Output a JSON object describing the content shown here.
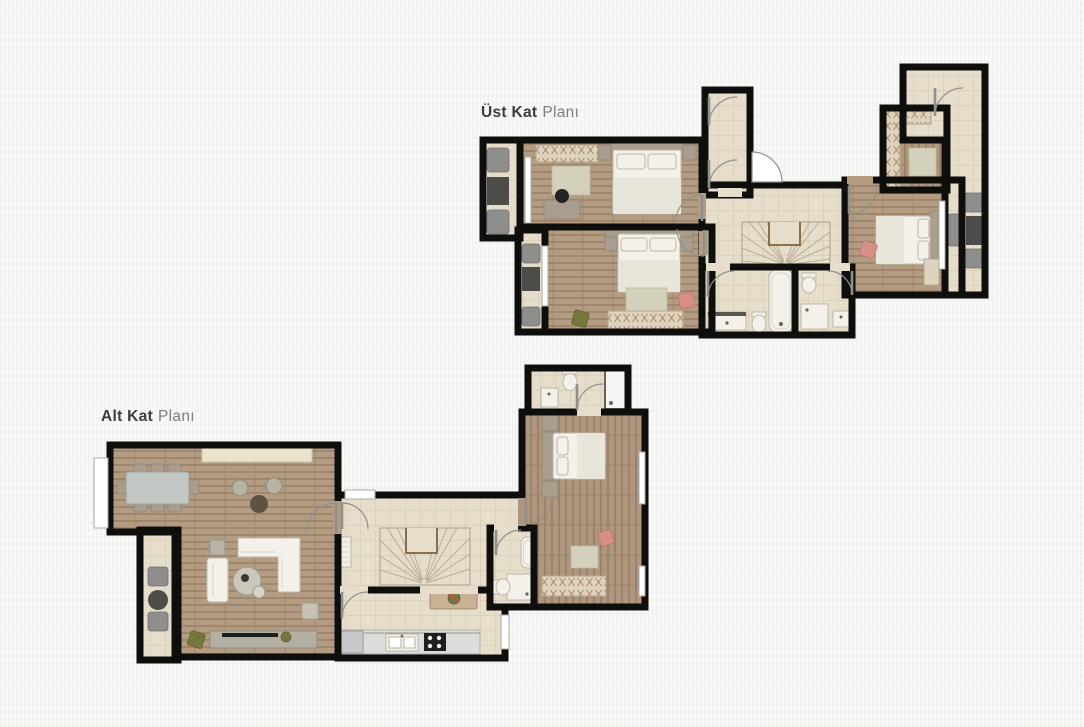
{
  "upper_plan": {
    "title_bold": "Üst Kat",
    "title_light": "Planı"
  },
  "lower_plan": {
    "title_bold": "Alt Kat",
    "title_light": "Planı"
  },
  "colors": {
    "paper": "#f8f8f5",
    "ink": "#3b3c3c",
    "inklight": "#7e7e79",
    "wall": "#0e0e0c",
    "wood": "#b49c83",
    "woodv": "#ae977e",
    "tile": "#e6ddcb",
    "tileline": "#d0c5ad",
    "closet": "#ddd3bf",
    "closetline": "#a9825a",
    "whitefurn": "#f3f1ea",
    "furnline": "#bdb7a7",
    "taupe": "#a99d8d",
    "rug": "#d3d0bb",
    "sofagray": "#8e8e8c",
    "darktable": "#4d4c49",
    "pink": "#d78e86",
    "green": "#77763f",
    "stairline": "#b8ad97",
    "woodedge": "#8a6f4d",
    "counter": "#dcdcda",
    "appliance": "#1e1e1e",
    "window": "#ffffff",
    "windowline": "#aaaaa6",
    "door": "#8f8f8c"
  }
}
